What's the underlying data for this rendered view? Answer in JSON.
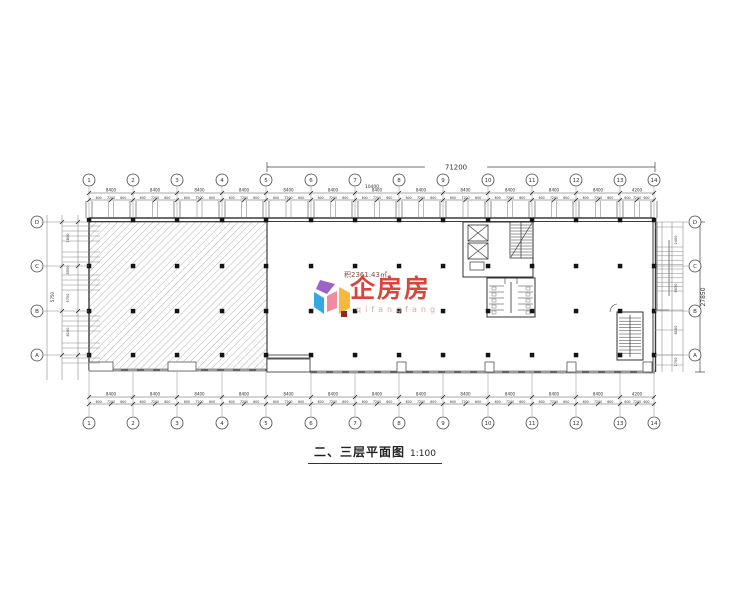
{
  "watermark": {
    "brand": "企房房",
    "subtext": "qifangfang",
    "area_note": "积2361.43㎡",
    "brand_color": "#D9453A",
    "logo_colors": {
      "blue": "#35A8E0",
      "purple": "#9E62C6",
      "yellow": "#F6B93B",
      "pink": "#F08CA0",
      "dark_red": "#8C2B22"
    }
  },
  "title": {
    "text": "二、三层平面图",
    "scale": "1:100"
  },
  "grid": {
    "top": [
      "1",
      "2",
      "3",
      "4",
      "5",
      "6",
      "7",
      "8",
      "9",
      "10",
      "11",
      "12",
      "13",
      "14"
    ],
    "bottom": [
      "1",
      "2",
      "3",
      "4",
      "5",
      "6",
      "7",
      "8",
      "9",
      "10",
      "11",
      "12",
      "13",
      "14"
    ],
    "left": [
      "D",
      "C",
      "B",
      "A"
    ],
    "right": [
      "D",
      "C",
      "B",
      "A"
    ]
  },
  "dims": {
    "overall_width": "71200",
    "mid_width": "10400",
    "overall_height": "27850",
    "left_height": "5750",
    "top_bays": [
      "8400",
      "8400",
      "8400",
      "8400",
      "8400",
      "8400",
      "8400",
      "8400",
      "8400",
      "8400",
      "8400",
      "8400",
      "4200"
    ],
    "bottom_bays": [
      "8400",
      "8400",
      "8400",
      "8400",
      "8400",
      "8400",
      "8400",
      "8400",
      "8400",
      "8400",
      "8400",
      "8400",
      "4200"
    ],
    "fine_pattern": [
      "600",
      "7200",
      "600"
    ],
    "left_vals": [
      "1800",
      "8050",
      "5750",
      "8100"
    ],
    "right_vals": [
      "2400",
      "8050",
      "8100",
      "1750"
    ]
  },
  "icons": {
    "elevator": "x-crossed-shaft",
    "stair": "tread-lines",
    "logo": "pinwheel-house"
  }
}
